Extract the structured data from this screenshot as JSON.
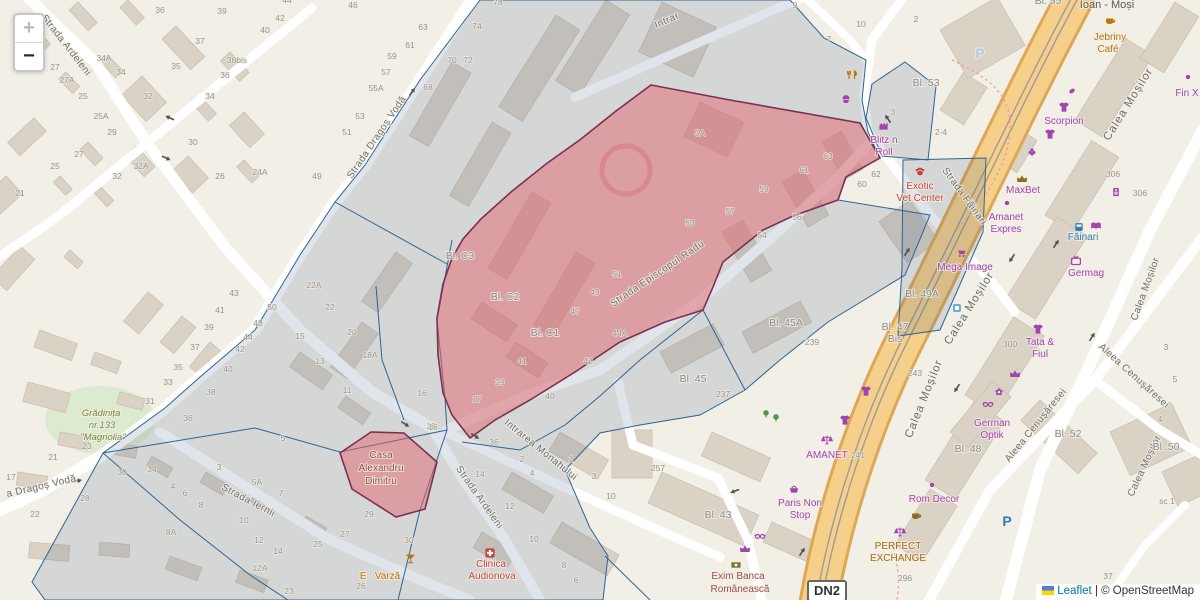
{
  "controls": {
    "zoom_in": "+",
    "zoom_out": "−"
  },
  "attribution": {
    "leaflet": "Leaflet",
    "separator": " | ",
    "osm": "© OpenStreetMap"
  },
  "road_shield": "DN2",
  "map": {
    "icon_colors": {
      "purple": "#a343ab",
      "red": "#c4453c",
      "orange": "#c07506",
      "green": "#4c9a4c",
      "blue": "#2f7cb2",
      "lightblue": "#5fa8d3",
      "brown": "#8a6d1f",
      "olive": "#7a7a2a"
    },
    "street_labels": [
      [
        "Strada Ardeleni",
        64,
        47,
        52,
        "street"
      ],
      [
        "Strada Dragoș Vodă",
        379,
        139,
        -56,
        "street"
      ],
      [
        "Intrar",
        668,
        23,
        -24,
        "street"
      ],
      [
        "Strada Episcopul Radu",
        659,
        276,
        -34,
        "street"
      ],
      [
        "Strada Făinari",
        962,
        198,
        54,
        "street"
      ],
      [
        "Calea Moșilor",
        1131,
        106,
        -58,
        "street-lg"
      ],
      [
        "Calea Moșilor",
        972,
        310,
        -58,
        "street-lg"
      ],
      [
        "Calea Moșilor",
        927,
        400,
        -68,
        "street-lg"
      ],
      [
        "Calea Moșilor",
        1148,
        290,
        -70,
        "street"
      ],
      [
        "Calea Moșilor",
        1147,
        467,
        -65,
        "street"
      ],
      [
        "Aleea Cenușăresei",
        1132,
        378,
        42,
        "street"
      ],
      [
        "Aleea Cenușăresei",
        1038,
        427,
        -51,
        "street"
      ],
      [
        "Intrarea Monahului",
        539,
        452,
        39,
        "street"
      ],
      [
        "Strada Ardeleni",
        477,
        499,
        55,
        "street"
      ],
      [
        "Strada Iernii",
        247,
        503,
        28,
        "street"
      ],
      [
        "a Dragoș Vodă",
        42,
        489,
        -13,
        "street"
      ]
    ],
    "poi_labels": [
      [
        "Exotic",
        920,
        189,
        "poi-red"
      ],
      [
        "Vet Center",
        920,
        201,
        "poi-red"
      ],
      [
        "MaxBet",
        1023,
        193,
        "poi-purple"
      ],
      [
        "Amanet",
        1006,
        220,
        "poi-purple"
      ],
      [
        "Expres",
        1006,
        232,
        "poi-purple"
      ],
      [
        "Mega Image",
        965,
        270,
        "poi-purple"
      ],
      [
        "Făinari",
        1083,
        240,
        "poi-blue"
      ],
      [
        "Germag",
        1086,
        276,
        "poi-purple"
      ],
      [
        "Tata &",
        1040,
        345,
        "poi-purple"
      ],
      [
        "Fiul",
        1040,
        357,
        "poi-purple"
      ],
      [
        "German",
        992,
        426,
        "poi-purple"
      ],
      [
        "Optik",
        992,
        438,
        "poi-purple"
      ],
      [
        "Rom Decor",
        934,
        502,
        "poi-purple"
      ],
      [
        "PERFECT",
        898,
        549,
        "poi-orange2"
      ],
      [
        "EXCHANGE",
        898,
        561,
        "poi-orange2"
      ],
      [
        "Paris Non",
        800,
        506,
        "poi-purple"
      ],
      [
        "Stop",
        800,
        518,
        "poi-purple"
      ],
      [
        "AMANET",
        827,
        458,
        "poi-purple"
      ],
      [
        "Exim Banca",
        738,
        579,
        "poi-darkred"
      ],
      [
        "Românească",
        740,
        592,
        "poi-darkred"
      ],
      [
        "Blitz n",
        884,
        143,
        "poi-purple"
      ],
      [
        "Roll",
        884,
        155,
        "poi-purple"
      ],
      [
        "Jebriny",
        1110,
        40,
        "poi-orange"
      ],
      [
        "Café",
        1108,
        52,
        "poi-orange"
      ],
      [
        "Ioan - Moși",
        1107,
        8,
        "poi-dark"
      ],
      [
        "Scorpion",
        1064,
        124,
        "poi-purple"
      ],
      [
        "Fin X",
        1187,
        96,
        "poi-purple"
      ],
      [
        "Clinica",
        491,
        567,
        "poi-red"
      ],
      [
        "Audionova",
        492,
        579,
        "poi-red"
      ],
      [
        "E : Varză",
        380,
        579,
        "poi-orange"
      ],
      [
        "Casa",
        381,
        458,
        "poi-darkred"
      ],
      [
        "Alexandru",
        381,
        471,
        "poi-darkred"
      ],
      [
        "Dimitru",
        381,
        484,
        "poi-darkred"
      ],
      [
        "Grădinița",
        101,
        416,
        "poi-green"
      ],
      [
        "nr.133",
        102,
        428,
        "poi-green"
      ],
      [
        "\"Magnolia\"",
        103,
        440,
        "poi-green"
      ],
      [
        "P",
        980,
        58,
        "parking-light"
      ],
      [
        "P",
        1007,
        526,
        "parking"
      ]
    ],
    "block_labels": [
      [
        "Bl. C3",
        460,
        259
      ],
      [
        "Bl. C2",
        505,
        300
      ],
      [
        "Bl. C1",
        545,
        336
      ],
      [
        "Bl. 45A",
        786,
        326
      ],
      [
        "Bl. 45",
        693,
        382
      ],
      [
        "Bl. 49A",
        922,
        297
      ],
      [
        "Bl. 47",
        895,
        330
      ],
      [
        "Bis",
        895,
        342
      ],
      [
        "Bl. 48",
        968,
        452
      ],
      [
        "Bl. 52",
        1068,
        437
      ],
      [
        "Bl. 50",
        1166,
        450
      ],
      [
        "Bl. 43",
        718,
        518
      ],
      [
        "Bl. 53",
        926,
        86
      ],
      [
        "Bl. 55",
        1048,
        4
      ]
    ],
    "house_numbers": [
      [
        "36",
        160,
        13
      ],
      [
        "39",
        222,
        14
      ],
      [
        "37",
        200,
        44
      ],
      [
        "34A",
        104,
        61
      ],
      [
        "34",
        121,
        75
      ],
      [
        "35",
        176,
        69
      ],
      [
        "36bis",
        237,
        63
      ],
      [
        "36",
        225,
        78
      ],
      [
        "34",
        210,
        99
      ],
      [
        "32",
        148,
        99
      ],
      [
        "42",
        280,
        21
      ],
      [
        "40",
        265,
        33
      ],
      [
        "44",
        287,
        3
      ],
      [
        "27",
        55,
        70
      ],
      [
        "27A",
        67,
        83
      ],
      [
        "25",
        83,
        99
      ],
      [
        "25A",
        101,
        119
      ],
      [
        "29",
        112,
        135
      ],
      [
        "27",
        79,
        157
      ],
      [
        "25",
        55,
        169
      ],
      [
        "21",
        20,
        196
      ],
      [
        "30",
        193,
        145
      ],
      [
        "26",
        220,
        179
      ],
      [
        "24A",
        260,
        175
      ],
      [
        "32A",
        141,
        169
      ],
      [
        "32",
        117,
        179
      ],
      [
        "46",
        353,
        8
      ],
      [
        "63",
        423,
        30
      ],
      [
        "61",
        410,
        48
      ],
      [
        "59",
        392,
        59
      ],
      [
        "57",
        386,
        75
      ],
      [
        "55A",
        376,
        91
      ],
      [
        "53",
        360,
        119
      ],
      [
        "51",
        347,
        135
      ],
      [
        "49",
        317,
        179
      ],
      [
        "68",
        428,
        90
      ],
      [
        "70",
        452,
        63
      ],
      [
        "72",
        468,
        63
      ],
      [
        "74",
        477,
        29
      ],
      [
        "78",
        498,
        5
      ],
      [
        "9",
        795,
        8
      ],
      [
        "7",
        829,
        42
      ],
      [
        "10",
        861,
        27
      ],
      [
        "3",
        893,
        115
      ],
      [
        "5A",
        700,
        136
      ],
      [
        "63",
        828,
        159
      ],
      [
        "61",
        804,
        173
      ],
      [
        "59",
        764,
        192
      ],
      [
        "62",
        876,
        177
      ],
      [
        "60",
        862,
        187
      ],
      [
        "57",
        730,
        214
      ],
      [
        "53",
        690,
        226
      ],
      [
        "54",
        762,
        238
      ],
      [
        "56",
        797,
        220
      ],
      [
        "51",
        617,
        277
      ],
      [
        "49",
        595,
        295
      ],
      [
        "47",
        575,
        314
      ],
      [
        "41",
        522,
        364
      ],
      [
        "39",
        500,
        385
      ],
      [
        "17",
        477,
        402
      ],
      [
        "44A",
        620,
        336
      ],
      [
        "42",
        588,
        364
      ],
      [
        "40",
        550,
        399
      ],
      [
        "43",
        234,
        296
      ],
      [
        "41",
        220,
        313
      ],
      [
        "39",
        209,
        330
      ],
      [
        "37",
        195,
        350
      ],
      [
        "35",
        178,
        370
      ],
      [
        "33",
        168,
        385
      ],
      [
        "38",
        211,
        395
      ],
      [
        "40",
        228,
        372
      ],
      [
        "42",
        240,
        352
      ],
      [
        "44",
        248,
        340
      ],
      [
        "48",
        258,
        326
      ],
      [
        "50",
        272,
        310
      ],
      [
        "22A",
        314,
        288
      ],
      [
        "22",
        330,
        310
      ],
      [
        "20",
        352,
        335
      ],
      [
        "18A",
        370,
        358
      ],
      [
        "15",
        300,
        339
      ],
      [
        "13",
        320,
        364
      ],
      [
        "11",
        347,
        393
      ],
      [
        "16",
        422,
        396
      ],
      [
        "16",
        431,
        429
      ],
      [
        "5",
        283,
        441
      ],
      [
        "31",
        150,
        404
      ],
      [
        "36",
        188,
        421
      ],
      [
        "23",
        87,
        449
      ],
      [
        "21",
        53,
        460
      ],
      [
        "17",
        11,
        480
      ],
      [
        "22",
        35,
        517
      ],
      [
        "28",
        85,
        501
      ],
      [
        "30",
        122,
        475
      ],
      [
        "34",
        152,
        472
      ],
      [
        "4",
        173,
        489
      ],
      [
        "6",
        185,
        496
      ],
      [
        "8",
        201,
        508
      ],
      [
        "8A",
        171,
        535
      ],
      [
        "3",
        219,
        470
      ],
      [
        "5A",
        257,
        485
      ],
      [
        "7",
        281,
        496
      ],
      [
        "10",
        244,
        523
      ],
      [
        "12",
        259,
        543
      ],
      [
        "14",
        278,
        554
      ],
      [
        "12A",
        260,
        571
      ],
      [
        "23",
        289,
        594
      ],
      [
        "16",
        433,
        430
      ],
      [
        "36",
        494,
        445
      ],
      [
        "2",
        522,
        462
      ],
      [
        "4",
        532,
        476
      ],
      [
        "1",
        571,
        462
      ],
      [
        "3",
        594,
        479
      ],
      [
        "14",
        480,
        477
      ],
      [
        "12",
        510,
        509
      ],
      [
        "10",
        534,
        542
      ],
      [
        "8",
        564,
        568
      ],
      [
        "6",
        576,
        583
      ],
      [
        "29",
        369,
        517
      ],
      [
        "27",
        345,
        537
      ],
      [
        "25",
        318,
        547
      ],
      [
        "30",
        409,
        543
      ],
      [
        "26",
        361,
        589
      ],
      [
        "10",
        611,
        499
      ],
      [
        "257",
        658,
        471
      ],
      [
        "237",
        723,
        397
      ],
      [
        "239",
        812,
        345
      ],
      [
        "241",
        858,
        458
      ],
      [
        "3",
        1166,
        350
      ],
      [
        "5",
        1175,
        382
      ],
      [
        "4",
        1160,
        422
      ],
      [
        "37",
        1108,
        579
      ],
      [
        "296",
        905,
        581
      ],
      [
        "300",
        1010,
        347
      ],
      [
        "243",
        915,
        376
      ],
      [
        "306",
        1113,
        177
      ],
      [
        "306",
        1140,
        196
      ],
      [
        "2",
        916,
        22
      ],
      [
        "2-4",
        941,
        135
      ],
      [
        "sc 1",
        1167,
        504
      ]
    ],
    "icons": [
      [
        "restaurant",
        852,
        75,
        "orange"
      ],
      [
        "cupcake",
        846,
        99,
        "purple"
      ],
      [
        "factory",
        884,
        126,
        "purple"
      ],
      [
        "paw",
        920,
        172,
        "red"
      ],
      [
        "crown",
        1022,
        179,
        "brown"
      ],
      [
        "gambling",
        1032,
        152,
        "purple"
      ],
      [
        "dot",
        1007,
        203,
        "purple"
      ],
      [
        "cart",
        961,
        253,
        "purple"
      ],
      [
        "bus",
        1079,
        227,
        "blue"
      ],
      [
        "book",
        1096,
        226,
        "purple"
      ],
      [
        "busstop",
        957,
        308,
        "lightblue"
      ],
      [
        "tv",
        1076,
        261,
        "purple"
      ],
      [
        "speaker",
        1116,
        192,
        "purple"
      ],
      [
        "shirt",
        1038,
        329,
        "purple"
      ],
      [
        "shirt",
        845,
        420,
        "purple"
      ],
      [
        "shirt",
        866,
        391,
        "purple"
      ],
      [
        "bean",
        1072,
        91,
        "purple"
      ],
      [
        "shirt",
        1064,
        107,
        "purple"
      ],
      [
        "shirt",
        1050,
        134,
        "purple"
      ],
      [
        "flower",
        999,
        392,
        "purple"
      ],
      [
        "glasses",
        988,
        404,
        "purple"
      ],
      [
        "crown",
        1015,
        374,
        "purple"
      ],
      [
        "cup",
        916,
        516,
        "brown"
      ],
      [
        "dot",
        932,
        485,
        "purple"
      ],
      [
        "scales",
        827,
        440,
        "purple"
      ],
      [
        "scales",
        900,
        532,
        "purple"
      ],
      [
        "money",
        736,
        565,
        "olive"
      ],
      [
        "basket",
        794,
        489,
        "purple"
      ],
      [
        "crown",
        745,
        549,
        "purple"
      ],
      [
        "glasses",
        760,
        536,
        "purple"
      ],
      [
        "cup",
        1110,
        21,
        "orange"
      ],
      [
        "dot",
        1188,
        77,
        "purple"
      ],
      [
        "clinic",
        490,
        553,
        "red"
      ],
      [
        "cocktail",
        410,
        559,
        "orange"
      ],
      [
        "tree",
        766,
        414,
        "green"
      ],
      [
        "tree",
        776,
        418,
        "green"
      ]
    ],
    "arrows": [
      [
        170,
        118,
        205
      ],
      [
        166,
        158,
        25
      ],
      [
        412,
        92,
        -55
      ],
      [
        77,
        481,
        -13
      ],
      [
        405,
        424,
        33
      ],
      [
        475,
        436,
        33
      ],
      [
        1012,
        258,
        123
      ],
      [
        1056,
        244,
        -57
      ],
      [
        957,
        388,
        123
      ],
      [
        1092,
        337,
        -57
      ],
      [
        802,
        552,
        -57
      ],
      [
        907,
        252,
        -57
      ],
      [
        735,
        491,
        160
      ],
      [
        888,
        119,
        235
      ]
    ]
  }
}
